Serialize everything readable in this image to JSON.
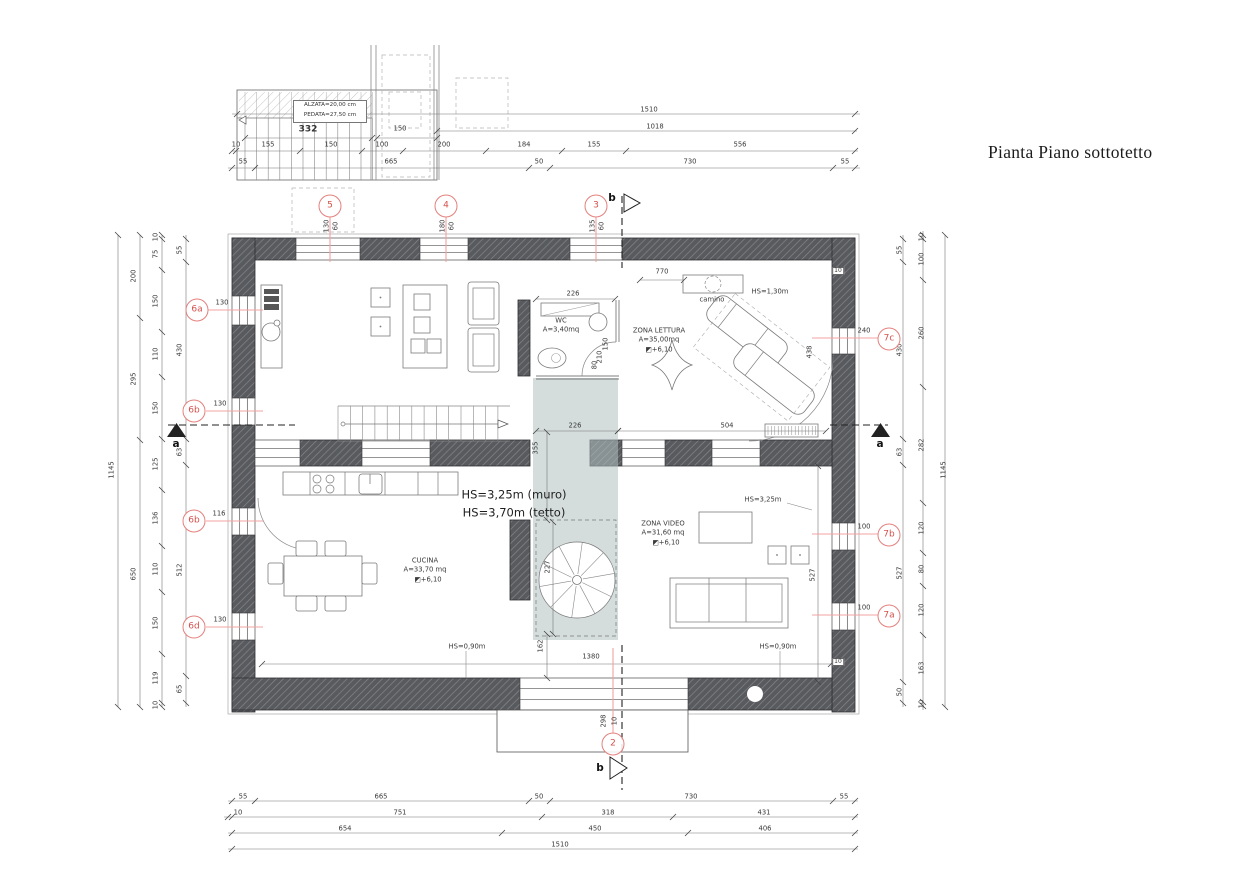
{
  "title": "Pianta Piano sottotetto",
  "colors": {
    "wall": "#585a5e",
    "wall_hatch": "#83868c",
    "marker": "#e4807d",
    "marker_text": "#d5504c",
    "leader": "#f0a3a0",
    "stairwell_shade": "#b1c0c0",
    "line": "#555555"
  },
  "stair_detail": {
    "note_line1": "ALZATA=20,00 cm",
    "note_line2": "PEDATA=27,50 cm"
  },
  "rooms": [
    {
      "name": "WC",
      "area": "A=3,40mq"
    },
    {
      "name": "ZONA LETTURA",
      "area": "A=35,00mq",
      "level": "+6,10"
    },
    {
      "name": "CUCINA",
      "area": "A=33,70 mq",
      "level": "+6,10"
    },
    {
      "name": "ZONA VIDEO",
      "area": "A=31,60 mq",
      "level": "+6,10"
    }
  ],
  "markers": [
    {
      "id": "5",
      "x": 330,
      "y": 206
    },
    {
      "id": "4",
      "x": 446,
      "y": 206
    },
    {
      "id": "3",
      "x": 596,
      "y": 206
    },
    {
      "id": "2",
      "x": 613,
      "y": 744
    },
    {
      "id": "6a",
      "x": 197,
      "y": 310
    },
    {
      "id": "6b",
      "x": 194,
      "y": 411
    },
    {
      "id": "6b",
      "x": 194,
      "y": 521
    },
    {
      "id": "6d",
      "x": 194,
      "y": 627
    },
    {
      "id": "7c",
      "x": 889,
      "y": 339
    },
    {
      "id": "7b",
      "x": 889,
      "y": 535
    },
    {
      "id": "7a",
      "x": 889,
      "y": 616
    }
  ],
  "labels": [
    {
      "t": "1510",
      "x": 649,
      "y": 110,
      "g": "dim-top"
    },
    {
      "t": "1018",
      "x": 655,
      "y": 127,
      "g": "dim-top"
    },
    {
      "t": "10",
      "x": 236,
      "y": 145,
      "g": "dim-top"
    },
    {
      "t": "155",
      "x": 268,
      "y": 145,
      "g": "dim-top"
    },
    {
      "t": "150",
      "x": 331,
      "y": 145,
      "g": "dim-top"
    },
    {
      "t": "100",
      "x": 382,
      "y": 145,
      "g": "dim-top"
    },
    {
      "t": "200",
      "x": 444,
      "y": 145,
      "g": "dim-top"
    },
    {
      "t": "184",
      "x": 524,
      "y": 145,
      "g": "dim-top"
    },
    {
      "t": "155",
      "x": 594,
      "y": 145,
      "g": "dim-top"
    },
    {
      "t": "556",
      "x": 740,
      "y": 145,
      "g": "dim-top"
    },
    {
      "t": "55",
      "x": 243,
      "y": 162,
      "g": "dim-top"
    },
    {
      "t": "665",
      "x": 391,
      "y": 162,
      "g": "dim-top"
    },
    {
      "t": "50",
      "x": 539,
      "y": 162,
      "g": "dim-top"
    },
    {
      "t": "730",
      "x": 690,
      "y": 162,
      "g": "dim-top"
    },
    {
      "t": "55",
      "x": 845,
      "y": 162,
      "g": "dim-top"
    },
    {
      "t": "332",
      "x": 308,
      "y": 130,
      "g": "stair-detail",
      "c": "b9"
    },
    {
      "t": "150",
      "x": 400,
      "y": 129,
      "g": "stair-detail"
    },
    {
      "t": "55",
      "x": 243,
      "y": 797,
      "g": "dim-bottom"
    },
    {
      "t": "665",
      "x": 381,
      "y": 797,
      "g": "dim-bottom"
    },
    {
      "t": "50",
      "x": 539,
      "y": 797,
      "g": "dim-bottom"
    },
    {
      "t": "730",
      "x": 691,
      "y": 797,
      "g": "dim-bottom"
    },
    {
      "t": "55",
      "x": 844,
      "y": 797,
      "g": "dim-bottom"
    },
    {
      "t": "10",
      "x": 238,
      "y": 813,
      "g": "dim-bottom"
    },
    {
      "t": "751",
      "x": 400,
      "y": 813,
      "g": "dim-bottom"
    },
    {
      "t": "318",
      "x": 608,
      "y": 813,
      "g": "dim-bottom"
    },
    {
      "t": "431",
      "x": 764,
      "y": 813,
      "g": "dim-bottom"
    },
    {
      "t": "654",
      "x": 345,
      "y": 829,
      "g": "dim-bottom"
    },
    {
      "t": "450",
      "x": 595,
      "y": 829,
      "g": "dim-bottom"
    },
    {
      "t": "406",
      "x": 765,
      "y": 829,
      "g": "dim-bottom"
    },
    {
      "t": "1510",
      "x": 560,
      "y": 845,
      "g": "dim-bottom"
    },
    {
      "t": "1145",
      "x": 112,
      "y": 470,
      "g": "dim-left",
      "c": "r"
    },
    {
      "t": "200",
      "x": 134,
      "y": 276,
      "g": "dim-left",
      "c": "r"
    },
    {
      "t": "295",
      "x": 134,
      "y": 379,
      "g": "dim-left",
      "c": "r"
    },
    {
      "t": "650",
      "x": 134,
      "y": 574,
      "g": "dim-left",
      "c": "r"
    },
    {
      "t": "10",
      "x": 156,
      "y": 237,
      "g": "dim-left",
      "c": "r"
    },
    {
      "t": "75",
      "x": 156,
      "y": 254,
      "g": "dim-left",
      "c": "r"
    },
    {
      "t": "150",
      "x": 156,
      "y": 301,
      "g": "dim-left",
      "c": "r"
    },
    {
      "t": "110",
      "x": 156,
      "y": 354,
      "g": "dim-left",
      "c": "r"
    },
    {
      "t": "150",
      "x": 156,
      "y": 408,
      "g": "dim-left",
      "c": "r"
    },
    {
      "t": "125",
      "x": 156,
      "y": 464,
      "g": "dim-left",
      "c": "r"
    },
    {
      "t": "136",
      "x": 156,
      "y": 518,
      "g": "dim-left",
      "c": "r"
    },
    {
      "t": "110",
      "x": 156,
      "y": 569,
      "g": "dim-left",
      "c": "r"
    },
    {
      "t": "150",
      "x": 156,
      "y": 623,
      "g": "dim-left",
      "c": "r"
    },
    {
      "t": "119",
      "x": 156,
      "y": 678,
      "g": "dim-left",
      "c": "r"
    },
    {
      "t": "10",
      "x": 156,
      "y": 705,
      "g": "dim-left",
      "c": "r"
    },
    {
      "t": "55",
      "x": 180,
      "y": 250,
      "g": "dim-left",
      "c": "r"
    },
    {
      "t": "430",
      "x": 180,
      "y": 350,
      "g": "dim-left",
      "c": "r"
    },
    {
      "t": "63",
      "x": 180,
      "y": 452,
      "g": "dim-left",
      "c": "r"
    },
    {
      "t": "512",
      "x": 180,
      "y": 570,
      "g": "dim-left",
      "c": "r"
    },
    {
      "t": "65",
      "x": 180,
      "y": 689,
      "g": "dim-left",
      "c": "r"
    },
    {
      "t": "55",
      "x": 900,
      "y": 250,
      "g": "dim-right",
      "c": "r"
    },
    {
      "t": "430",
      "x": 900,
      "y": 350,
      "g": "dim-right",
      "c": "r"
    },
    {
      "t": "63",
      "x": 900,
      "y": 452,
      "g": "dim-right",
      "c": "r"
    },
    {
      "t": "527",
      "x": 900,
      "y": 573,
      "g": "dim-right",
      "c": "r"
    },
    {
      "t": "50",
      "x": 900,
      "y": 692,
      "g": "dim-right",
      "c": "r"
    },
    {
      "t": "10",
      "x": 922,
      "y": 237,
      "g": "dim-right",
      "c": "r"
    },
    {
      "t": "100",
      "x": 922,
      "y": 259,
      "g": "dim-right",
      "c": "r"
    },
    {
      "t": "260",
      "x": 922,
      "y": 333,
      "g": "dim-right",
      "c": "r"
    },
    {
      "t": "282",
      "x": 922,
      "y": 445,
      "g": "dim-right",
      "c": "r"
    },
    {
      "t": "120",
      "x": 922,
      "y": 528,
      "g": "dim-right",
      "c": "r"
    },
    {
      "t": "80",
      "x": 922,
      "y": 569,
      "g": "dim-right",
      "c": "r"
    },
    {
      "t": "120",
      "x": 922,
      "y": 610,
      "g": "dim-right",
      "c": "r"
    },
    {
      "t": "163",
      "x": 922,
      "y": 668,
      "g": "dim-right",
      "c": "r"
    },
    {
      "t": "10",
      "x": 922,
      "y": 704,
      "g": "dim-right",
      "c": "r"
    },
    {
      "t": "1145",
      "x": 944,
      "y": 470,
      "g": "dim-right",
      "c": "r"
    },
    {
      "t": "130",
      "x": 327,
      "y": 226,
      "g": "window-dim",
      "c": "r"
    },
    {
      "t": "60",
      "x": 336,
      "y": 226,
      "g": "window-dim",
      "c": "r"
    },
    {
      "t": "180",
      "x": 443,
      "y": 226,
      "g": "window-dim",
      "c": "r"
    },
    {
      "t": "60",
      "x": 452,
      "y": 226,
      "g": "window-dim",
      "c": "r"
    },
    {
      "t": "135",
      "x": 593,
      "y": 226,
      "g": "window-dim",
      "c": "r"
    },
    {
      "t": "60",
      "x": 602,
      "y": 226,
      "g": "window-dim",
      "c": "r"
    },
    {
      "t": "298",
      "x": 604,
      "y": 721,
      "g": "window-dim",
      "c": "r"
    },
    {
      "t": "10",
      "x": 615,
      "y": 721,
      "g": "window-dim",
      "c": "r"
    },
    {
      "t": "130",
      "x": 222,
      "y": 303,
      "g": "window-dim"
    },
    {
      "t": "130",
      "x": 220,
      "y": 404,
      "g": "window-dim"
    },
    {
      "t": "116",
      "x": 219,
      "y": 514,
      "g": "window-dim"
    },
    {
      "t": "130",
      "x": 220,
      "y": 620,
      "g": "window-dim"
    },
    {
      "t": "240",
      "x": 864,
      "y": 331,
      "g": "window-dim"
    },
    {
      "t": "100",
      "x": 864,
      "y": 527,
      "g": "window-dim"
    },
    {
      "t": "100",
      "x": 864,
      "y": 608,
      "g": "window-dim"
    },
    {
      "t": "226",
      "x": 573,
      "y": 294,
      "g": "dim-interior"
    },
    {
      "t": "226",
      "x": 575,
      "y": 426,
      "g": "dim-interior"
    },
    {
      "t": "504",
      "x": 727,
      "y": 426,
      "g": "dim-interior"
    },
    {
      "t": "770",
      "x": 662,
      "y": 272,
      "g": "dim-interior"
    },
    {
      "t": "1380",
      "x": 591,
      "y": 657,
      "g": "dim-interior"
    },
    {
      "t": "355",
      "x": 536,
      "y": 448,
      "g": "dim-interior",
      "c": "r"
    },
    {
      "t": "227",
      "x": 548,
      "y": 567,
      "g": "dim-interior",
      "c": "r"
    },
    {
      "t": "162",
      "x": 541,
      "y": 646,
      "g": "dim-interior",
      "c": "r"
    },
    {
      "t": "438",
      "x": 810,
      "y": 352,
      "g": "dim-interior",
      "c": "r"
    },
    {
      "t": "527",
      "x": 813,
      "y": 575,
      "g": "dim-interior",
      "c": "r"
    },
    {
      "t": "150",
      "x": 606,
      "y": 344,
      "g": "dim-interior",
      "c": "r"
    },
    {
      "t": "210",
      "x": 600,
      "y": 357,
      "g": "dim-interior",
      "c": "r"
    },
    {
      "t": "80",
      "x": 595,
      "y": 365,
      "g": "dim-interior",
      "c": "r"
    },
    {
      "t": "10",
      "x": 838,
      "y": 271,
      "g": "dim-interior",
      "c": "bx"
    },
    {
      "t": "10",
      "x": 838,
      "y": 662,
      "g": "dim-interior",
      "c": "bx"
    },
    {
      "t": "WC",
      "x": 561,
      "y": 321,
      "g": "room"
    },
    {
      "t": "A=3,40mq",
      "x": 561,
      "y": 330,
      "g": "room"
    },
    {
      "t": "ZONA LETTURA",
      "x": 659,
      "y": 331,
      "g": "room"
    },
    {
      "t": "A=35,00mq",
      "x": 659,
      "y": 340,
      "g": "room"
    },
    {
      "t": "◩+6,10",
      "x": 659,
      "y": 350,
      "g": "room"
    },
    {
      "t": "camino",
      "x": 712,
      "y": 300,
      "g": "room"
    },
    {
      "t": "CUCINA",
      "x": 425,
      "y": 561,
      "g": "room"
    },
    {
      "t": "A=33,70 mq",
      "x": 425,
      "y": 570,
      "g": "room"
    },
    {
      "t": "◩+6,10",
      "x": 428,
      "y": 580,
      "g": "room"
    },
    {
      "t": "ZONA VIDEO",
      "x": 663,
      "y": 524,
      "g": "room"
    },
    {
      "t": "A=31,60 mq",
      "x": 663,
      "y": 533,
      "g": "room"
    },
    {
      "t": "◩+6,10",
      "x": 666,
      "y": 543,
      "g": "room"
    },
    {
      "t": "HS=1,30m",
      "x": 770,
      "y": 292,
      "g": "note"
    },
    {
      "t": "HS=3,25m (muro)",
      "x": 514,
      "y": 495,
      "g": "note",
      "c": "n"
    },
    {
      "t": "HS=3,70m (tetto)",
      "x": 514,
      "y": 513,
      "g": "note",
      "c": "n"
    },
    {
      "t": "HS=3,25m",
      "x": 763,
      "y": 500,
      "g": "note"
    },
    {
      "t": "HS=0,90m",
      "x": 467,
      "y": 647,
      "g": "note"
    },
    {
      "t": "HS=0,90m",
      "x": 778,
      "y": 647,
      "g": "note"
    },
    {
      "t": "a",
      "x": 176,
      "y": 444,
      "g": "section",
      "c": "sc"
    },
    {
      "t": "a",
      "x": 880,
      "y": 444,
      "g": "section",
      "c": "sc"
    },
    {
      "t": "b",
      "x": 612,
      "y": 198,
      "g": "section",
      "c": "sc"
    },
    {
      "t": "b",
      "x": 600,
      "y": 768,
      "g": "section",
      "c": "sc"
    }
  ]
}
